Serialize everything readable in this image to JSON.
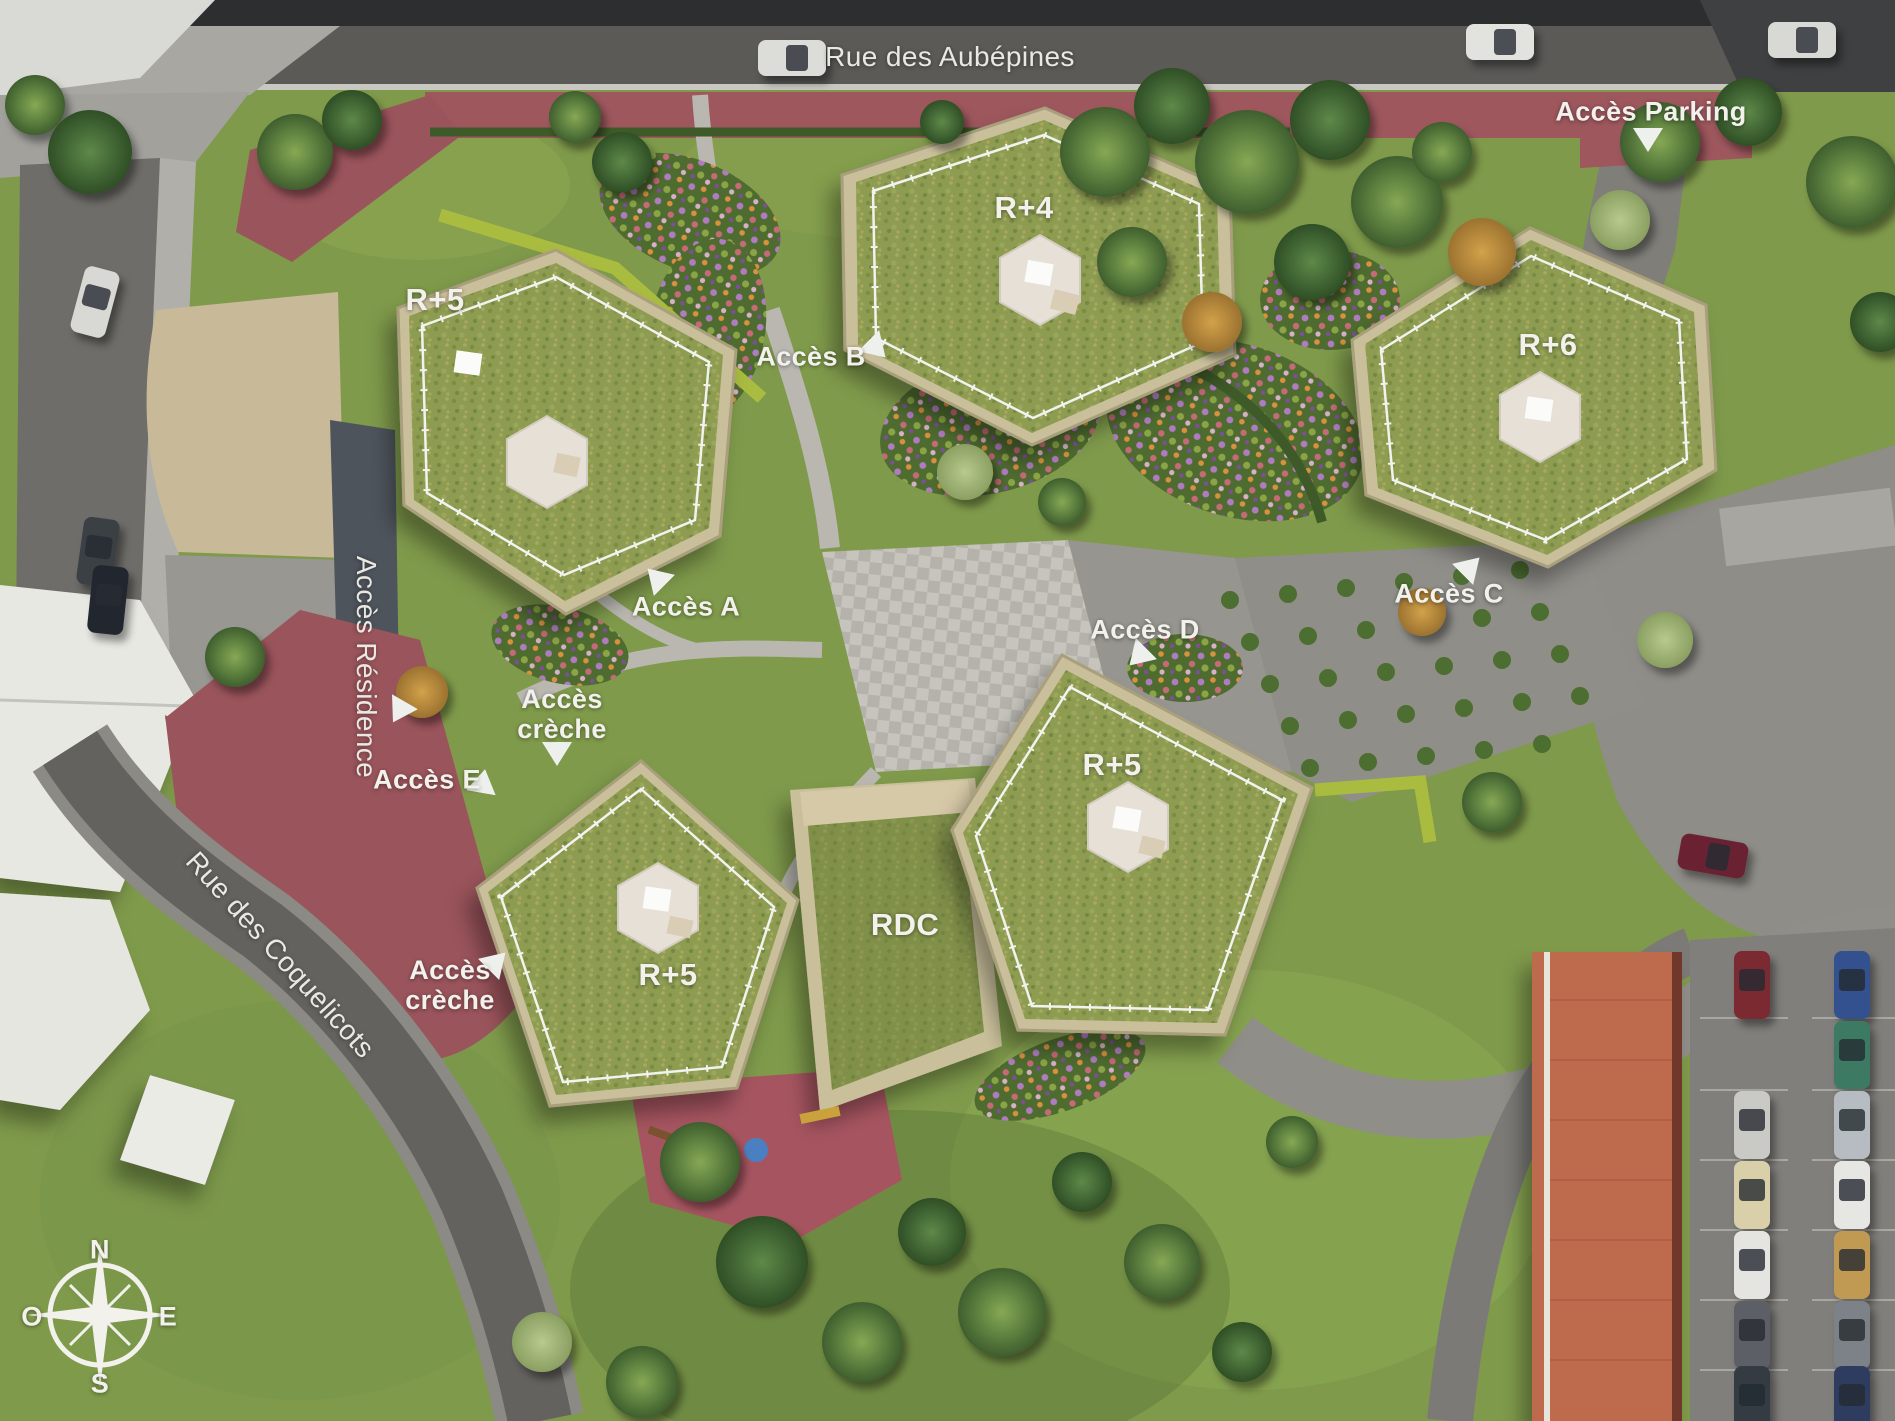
{
  "labels": {
    "street_top": "Rue des Aubépines",
    "street_left": "Rue des Coquelicots",
    "acces_parking": "Accès Parking",
    "acces_residence": "Accès Résidence",
    "acces_a": "Accès A",
    "acces_b": "Accès B",
    "acces_c": "Accès C",
    "acces_d": "Accès D",
    "acces_e": "Accès E",
    "acces_creche_line1": "Accès",
    "acces_creche_line2": "crèche"
  },
  "buildings": {
    "north": "R+4",
    "west": "R+5",
    "east": "R+6",
    "center": "R+5",
    "southwest": "R+5",
    "ground_floor": "RDC"
  },
  "compass": {
    "north": "N",
    "south": "S",
    "east": "E",
    "west": "O"
  },
  "colors": {
    "label": "#f2f1ec",
    "red_path": "#9d575d",
    "roof_grass": "#8d9c51",
    "building_wall": "#c9bf9b",
    "asphalt": "#55544f"
  }
}
